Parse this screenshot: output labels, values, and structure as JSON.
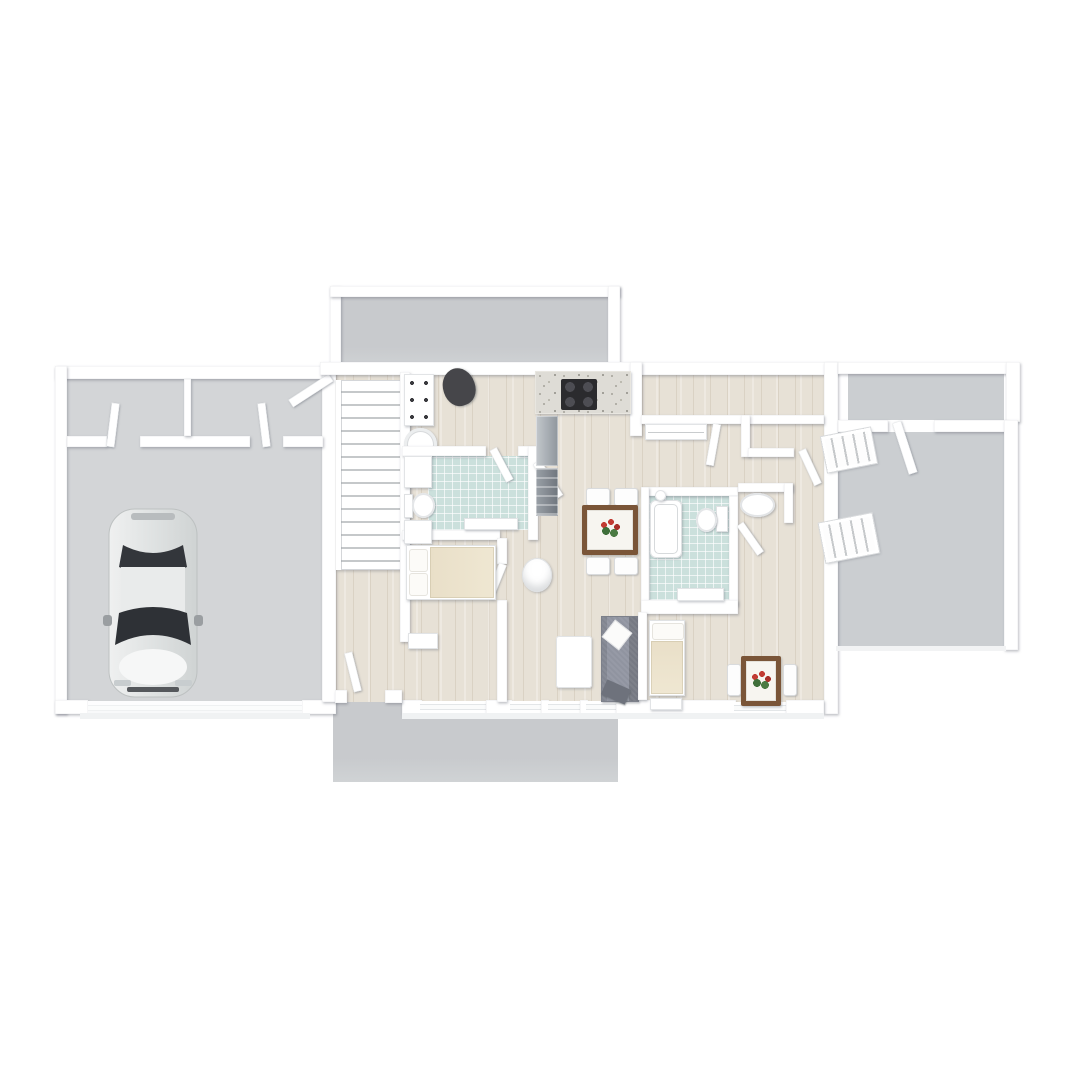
{
  "scene": {
    "type": "3d-floor-plan-render",
    "view": "top-down",
    "background": "#ffffff",
    "visible_text": ""
  },
  "colors": {
    "wall": "#ffffff",
    "wood": "#e7e1d6",
    "tile": "#cbe0dc",
    "concrete": "#d3d5d7",
    "deck": "#c8cacd",
    "bonus": "#cbced1",
    "counter": "#dedcd6",
    "cooktop": "#2b2b2e",
    "stainless_light": "#c3c8cc",
    "stainless_dark": "#8f969d",
    "couch": "#9094a0",
    "wood_table": "#7a5538",
    "bed_blanket": "#e9dfc8",
    "flower_red": "#c23b33",
    "leaf_green": "#4a7a42",
    "car_body": "#e4e6e6",
    "car_glass": "#33363b"
  },
  "floorplan": {
    "rooms": [
      {
        "name": "garage",
        "floor": "concrete"
      },
      {
        "name": "storage-closet-left",
        "floor": "concrete"
      },
      {
        "name": "storage-closet-right",
        "floor": "concrete"
      },
      {
        "name": "upper-terrace",
        "floor": "deck"
      },
      {
        "name": "staircase",
        "floor": "stairs"
      },
      {
        "name": "laundry-room",
        "floor": "wood"
      },
      {
        "name": "bathroom-1",
        "floor": "tile"
      },
      {
        "name": "kitchen",
        "floor": "wood"
      },
      {
        "name": "dining-living-area",
        "floor": "wood"
      },
      {
        "name": "bedroom-1",
        "floor": "wood"
      },
      {
        "name": "hallway",
        "floor": "wood"
      },
      {
        "name": "bedroom-2",
        "floor": "wood"
      },
      {
        "name": "bathroom-2",
        "floor": "tile"
      },
      {
        "name": "bedroom-3",
        "floor": "wood"
      },
      {
        "name": "bonus-room",
        "floor": "gray"
      },
      {
        "name": "upper-balcony",
        "floor": "gray"
      },
      {
        "name": "lower-terrace",
        "floor": "deck"
      }
    ],
    "furniture": [
      "car",
      "laundry-cabinet",
      "laundry-chair",
      "washer",
      "bathroom1-cabinet",
      "toilet-1",
      "vanity-1",
      "shower-mat",
      "kitchen-counter",
      "cooktop",
      "refrigerator",
      "kitchen-lower-unit",
      "dining-table",
      "dining-chairs-x4",
      "flower-centerpiece",
      "round-stool",
      "sofa",
      "coffee-table",
      "bed-1",
      "dresser-1",
      "closet-shelf",
      "bathtub",
      "toilet-2",
      "vanity-2",
      "pedestal-sink",
      "bed-3",
      "dresser-3",
      "desk-table",
      "desk-chairs-x2",
      "flower-vase",
      "entry-steps-x2"
    ],
    "features": [
      "garage-door",
      "open-door-leaves",
      "windows-bottom-wall"
    ]
  }
}
